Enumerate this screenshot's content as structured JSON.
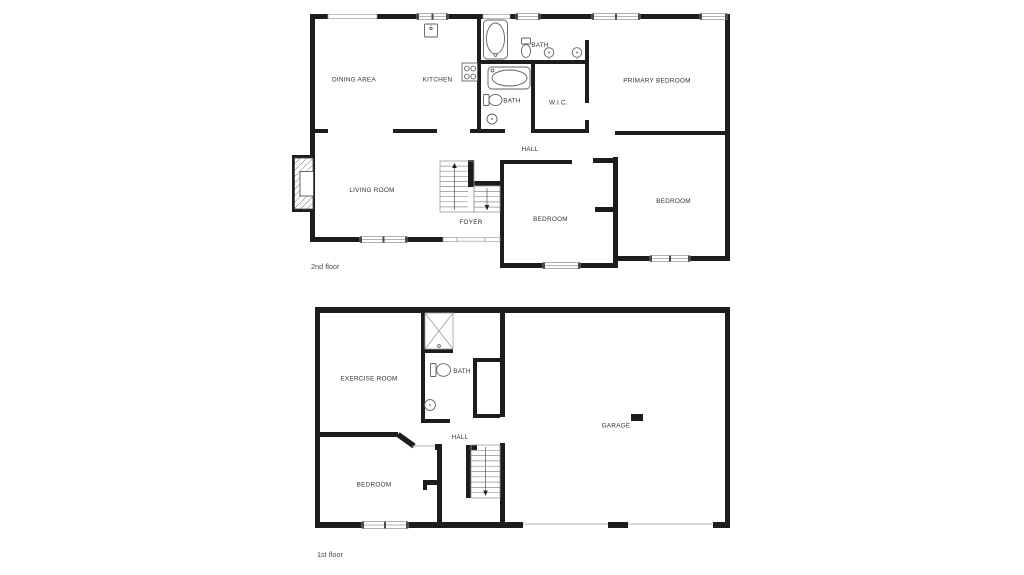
{
  "title": "Two-storey floor plan",
  "colors": {
    "background": "#ffffff",
    "wall": "#1d1d1d",
    "window_frame": "#9c9c9c",
    "fixture_outline": "#606060",
    "room_label": "#333333",
    "floor_label": "#4a4a4a"
  },
  "floors": {
    "second": {
      "floor_label": "2nd floor",
      "rooms": {
        "dining": "DINING AREA",
        "kitchen": "KITCHEN",
        "bath_upper": "BATH",
        "bath_lower": "BATH",
        "wic": "W.I.C.",
        "primary": "PRIMARY BEDROOM",
        "hall": "HALL",
        "living": "LIVING ROOM",
        "foyer": "FOYER",
        "bedroom_mid": "BEDROOM",
        "bedroom_right": "BEDROOM"
      },
      "fixtures": [
        "bathtub",
        "bathtub",
        "toilet",
        "toilet",
        "sink",
        "sink",
        "sink",
        "kitchen-sink",
        "stove",
        "fireplace",
        "staircase"
      ]
    },
    "first": {
      "floor_label": "1st floor",
      "rooms": {
        "exercise": "EXERCISE ROOM",
        "bath": "BATH",
        "hall": "HALL",
        "bedroom": "BEDROOM",
        "garage": "GARAGE"
      },
      "fixtures": [
        "shower",
        "toilet",
        "sink",
        "staircase",
        "garage-marker"
      ]
    }
  }
}
